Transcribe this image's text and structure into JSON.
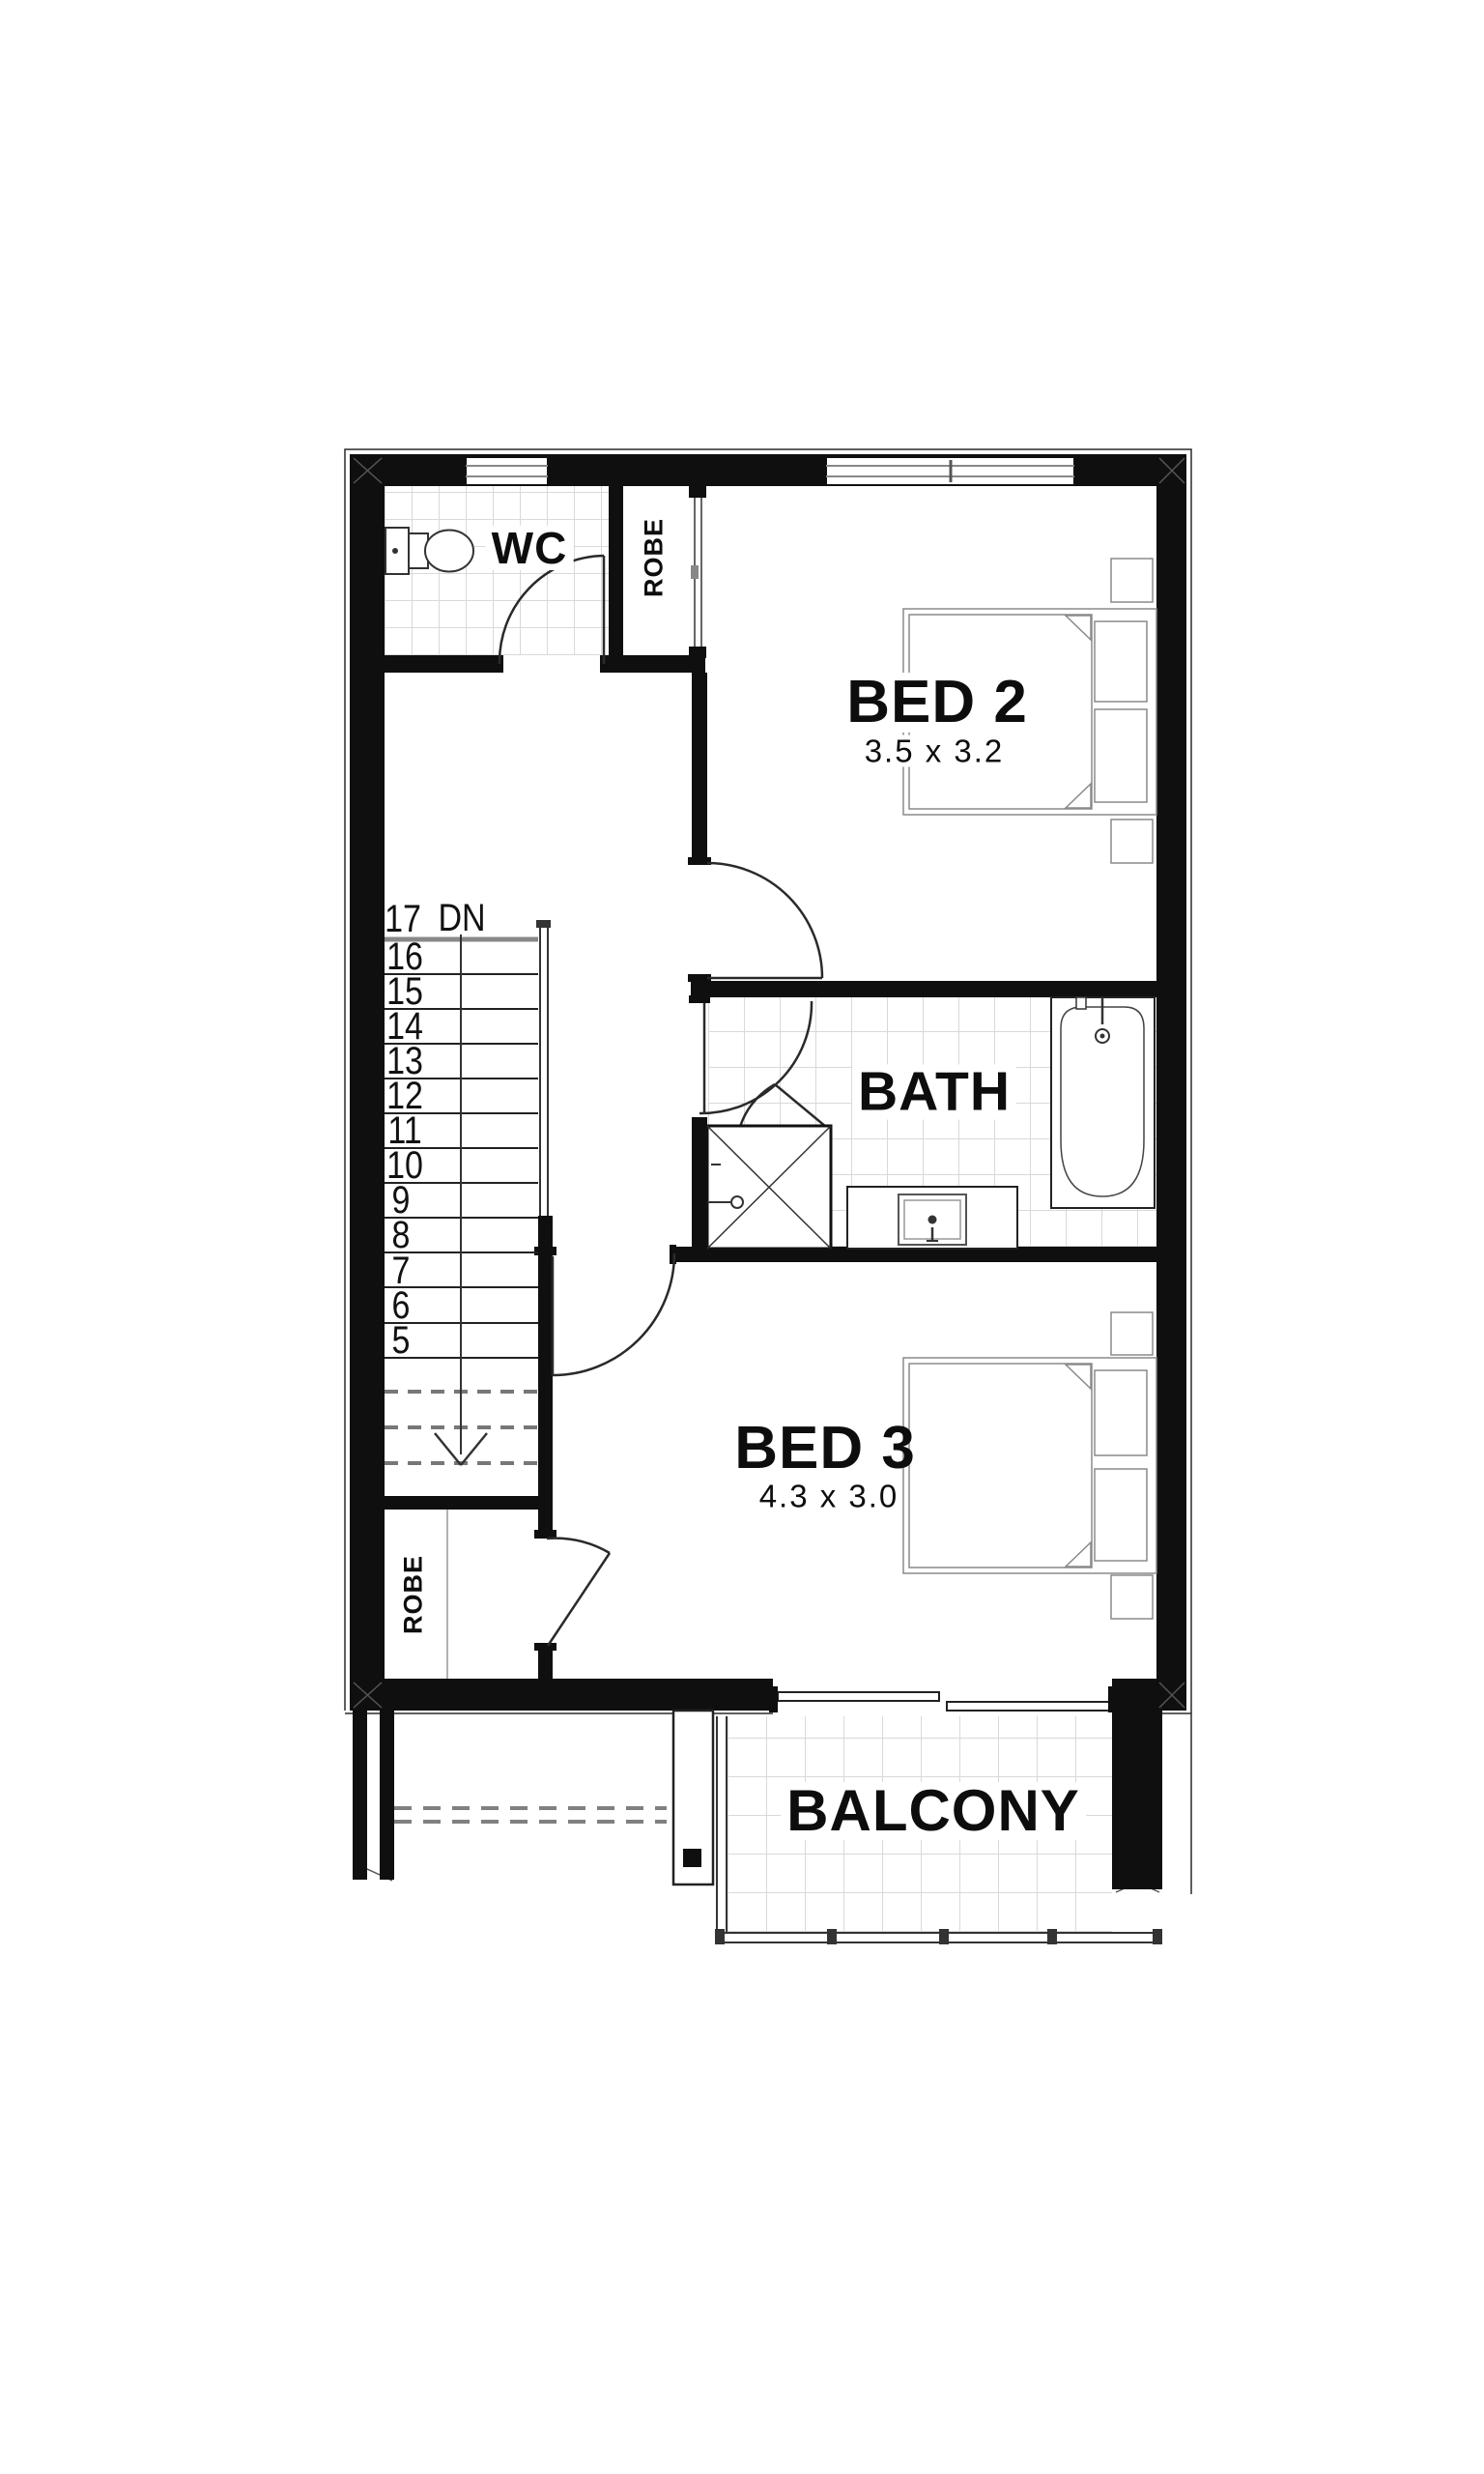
{
  "colors": {
    "wall": "#0f0f0f",
    "line": "#2a2a2a",
    "fixture": "#555555",
    "tile": "#d9d9d9",
    "dash": "#808080",
    "bg": "#ffffff"
  },
  "rooms": {
    "wc": {
      "label": "WC"
    },
    "robe_top": {
      "label": "ROBE"
    },
    "bed2": {
      "label": "BED 2",
      "dims": "3.5 x 3.2"
    },
    "bath": {
      "label": "BATH"
    },
    "bed3": {
      "label": "BED 3",
      "dims": "4.3 x 3.0"
    },
    "robe_bottom": {
      "label": "ROBE"
    },
    "balcony": {
      "label": "BALCONY"
    }
  },
  "stairs": {
    "top_step": "17",
    "direction": "DN",
    "numbers": [
      "16",
      "15",
      "14",
      "13",
      "12",
      "11",
      "10",
      "9",
      "8",
      "7",
      "6",
      "5"
    ]
  }
}
